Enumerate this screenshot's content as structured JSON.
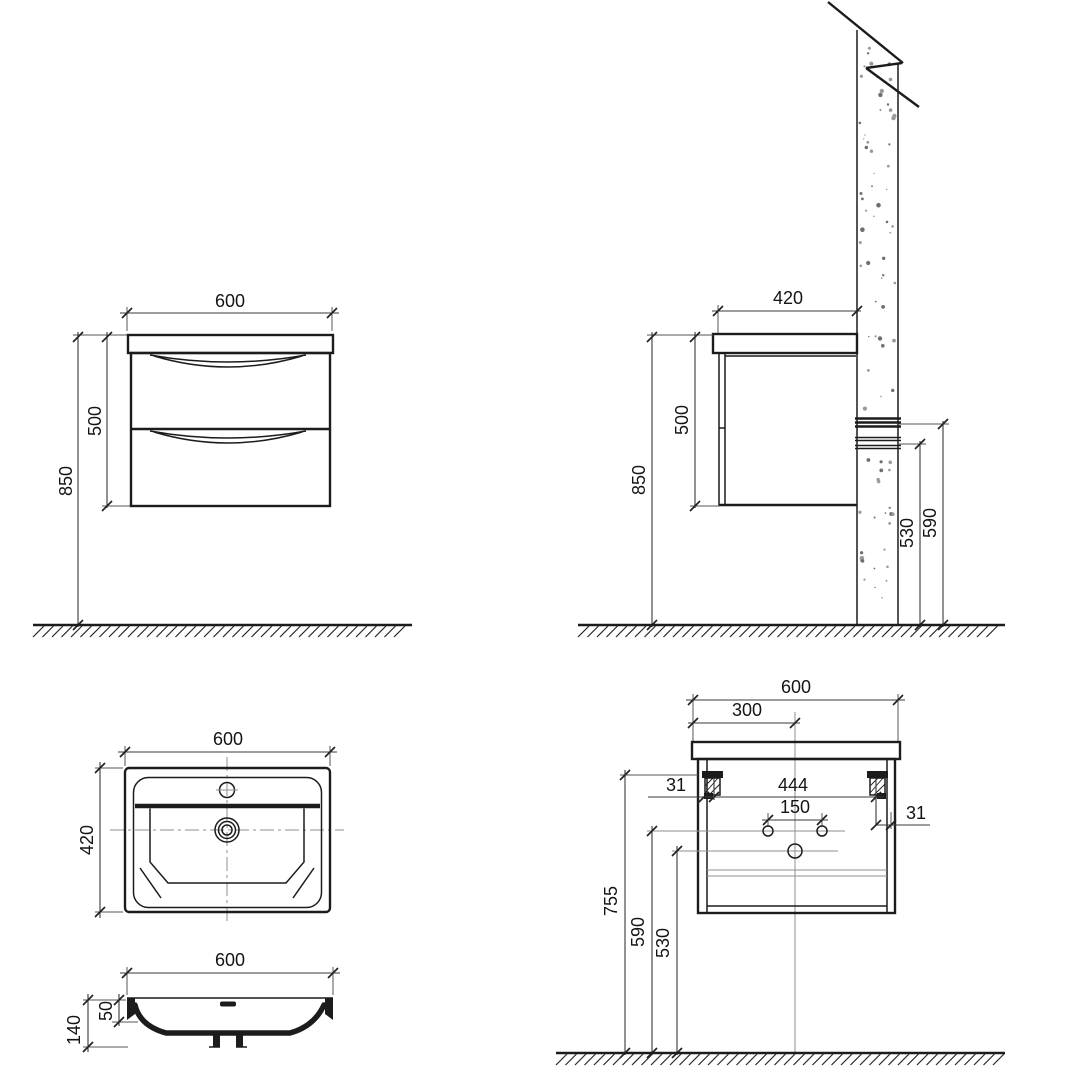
{
  "drawing": {
    "front_view": {
      "width": "600",
      "cabinet_height": "500",
      "mount_height": "850"
    },
    "side_view": {
      "depth": "420",
      "cabinet_height": "500",
      "mount_height": "850",
      "drain_height": "530",
      "supply_height": "590"
    },
    "basin_plan_view": {
      "width": "600",
      "depth": "420"
    },
    "basin_section_view": {
      "width": "600",
      "height": "140",
      "rim_height": "50"
    },
    "rear_view": {
      "width": "600",
      "centerline_offset": "300",
      "bracket_spacing": "444",
      "supply_hole_spacing": "150",
      "bracket_inset_left": "31",
      "bracket_inset_right": "31",
      "bracket_height": "755",
      "supply_height": "590",
      "drain_height": "530"
    }
  }
}
